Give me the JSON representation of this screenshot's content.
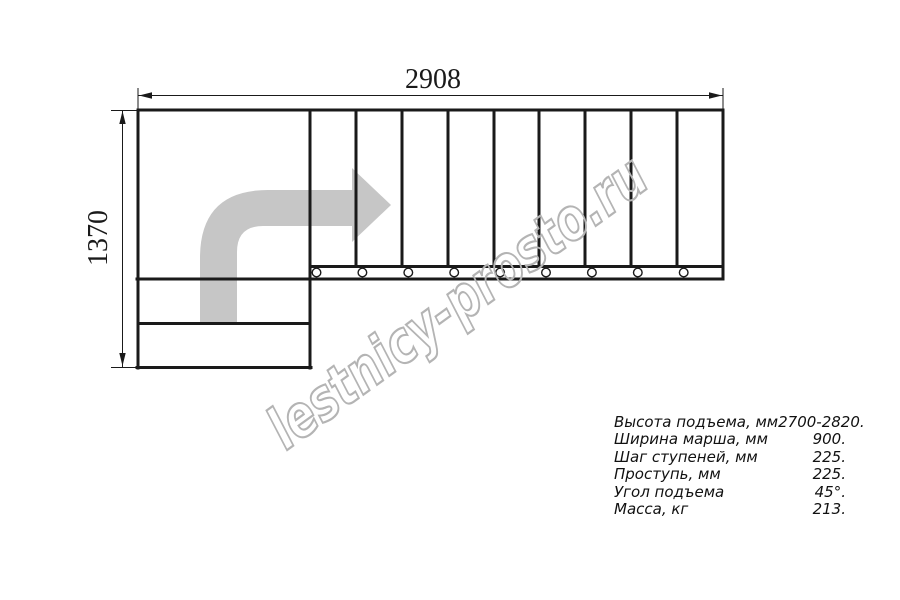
{
  "drawing": {
    "width_dim_label": "2908",
    "height_dim_label": "1370",
    "steps_count": 9,
    "watermark_text": "lestnicy-prosto.ru"
  },
  "colors": {
    "line": "#1a1a1a",
    "arrow_fill": "#c6c6c6",
    "watermark": "#b4b4b4"
  },
  "specs": {
    "rows": [
      {
        "label": "Высота подъема, мм",
        "value": "2700-2820."
      },
      {
        "label": "Ширина марша, мм",
        "value": "900."
      },
      {
        "label": "Шаг ступеней, мм",
        "value": "225."
      },
      {
        "label": "Проступь, мм",
        "value": "225."
      },
      {
        "label": "Угол подъема",
        "value": "45°."
      },
      {
        "label": "Масса, кг",
        "value": "213."
      }
    ]
  }
}
